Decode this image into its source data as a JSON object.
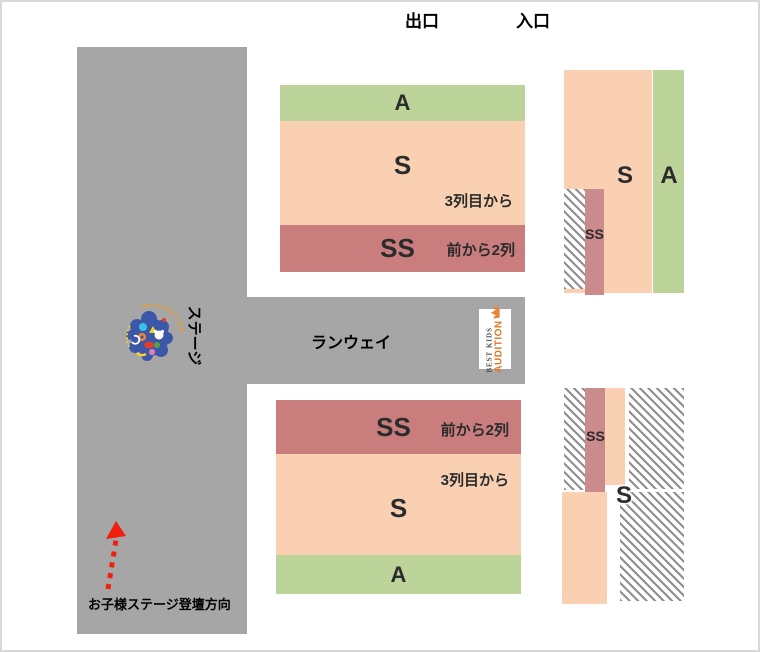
{
  "top_labels": {
    "exit": "出口",
    "entrance": "入口"
  },
  "stage": {
    "label": "ステージ",
    "arrow_caption": "お子様ステージ登壇方向",
    "logo_arc_text": "IMAGINATION"
  },
  "runway": {
    "label": "ランウェイ",
    "logo": {
      "line1": "BEST KIDS",
      "line2": "AUDITION"
    }
  },
  "sections": {
    "center_upper": {
      "a_label": "A",
      "s_label": "S",
      "ss_label": "SS",
      "s_note": "3列目から",
      "ss_note": "前から2列"
    },
    "center_lower": {
      "ss_label": "SS",
      "s_label": "S",
      "a_label": "A",
      "ss_note": "前から2列",
      "s_note": "3列目から"
    },
    "right_upper": {
      "s_label": "S",
      "a_label": "A",
      "ss_label": "SS"
    },
    "right_lower": {
      "ss_label": "SS",
      "s_label": "S"
    }
  },
  "colors": {
    "stage_gray": "#a6a6a6",
    "seat_a_green": "#bcd49a",
    "seat_s_peach": "#f9d0b2",
    "seat_ss_rose": "#c97d7d",
    "side_ss_rose": "#cb8a8c",
    "hatch_stripe_gray": "#8f8f8f",
    "arrow_red": "#f01f0f",
    "logo_orange": "#e0782a"
  }
}
